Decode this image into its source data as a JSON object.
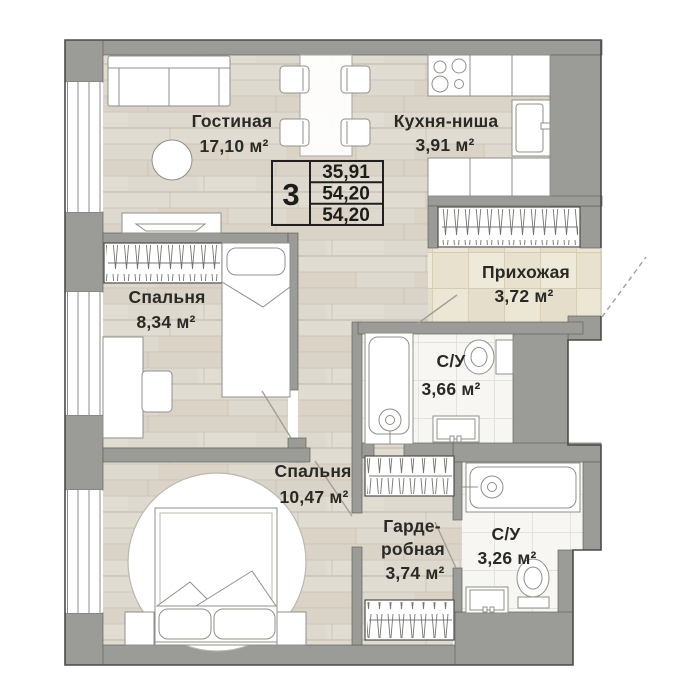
{
  "unit_table": {
    "rooms_count": "3",
    "row1": "35,91",
    "row2": "54,20",
    "row3": "54,20"
  },
  "rooms": {
    "living": {
      "name": "Гостиная",
      "area": "17,10 м²"
    },
    "kitchen": {
      "name": "Кухня-ниша",
      "area": "3,91 м²"
    },
    "hallway": {
      "name": "Прихожая",
      "area": "3,72 м²"
    },
    "bedroom1": {
      "name": "Спальня",
      "area": "8,34 м²"
    },
    "bathroom1": {
      "name": "С/У",
      "area": "3,66 м²"
    },
    "bedroom2": {
      "name": "Спальня",
      "area": "10,47 м²"
    },
    "wardrobe": {
      "name_line1": "Гарде-",
      "name_line2": "робная",
      "area": "3,74 м²"
    },
    "bathroom2": {
      "name": "С/У",
      "area": "3,26 м²"
    }
  },
  "colors": {
    "wall": "#9b9b98",
    "wall_outline": "#4b4b47",
    "wood_floor": "#ded9ce",
    "hall_tile": "#ece6d4",
    "bath_tile": "#f7f6f3",
    "text": "#292926"
  }
}
